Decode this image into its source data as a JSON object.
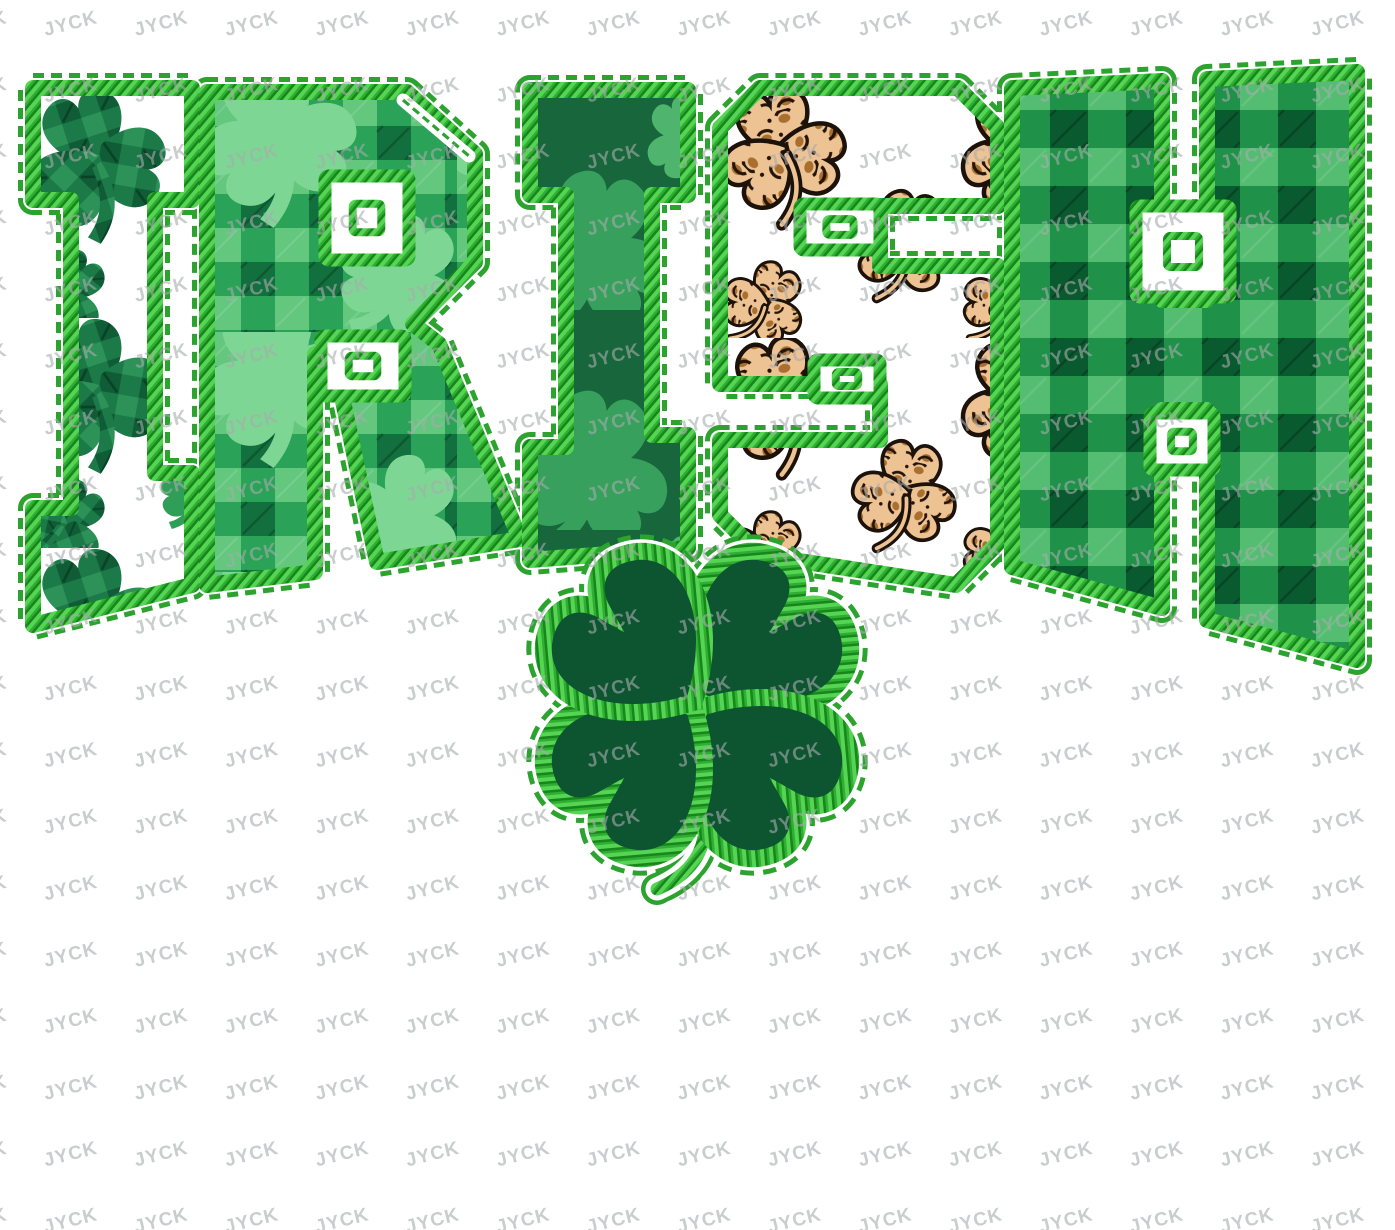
{
  "artwork": {
    "word": "IRISH",
    "letters": [
      {
        "char": "I",
        "fabric": "white-shamrock-plaid"
      },
      {
        "char": "R",
        "fabric": "green-buffalo-plaid-shamrock"
      },
      {
        "char": "I",
        "fabric": "dark-green-shamrock"
      },
      {
        "char": "S",
        "fabric": "leopard-shamrock-white"
      },
      {
        "char": "H",
        "fabric": "green-buffalo-plaid"
      }
    ],
    "motif": "four-leaf-clover"
  },
  "watermark": {
    "text": "JYCK",
    "color": "#a8acad"
  },
  "colors": {
    "background": "#ffffff",
    "stitch_green": "#2da32f",
    "satin_light": "#56d453",
    "satin_mid": "#2fae33",
    "satin_dark": "#17861b",
    "clover_fill": "#0d5431",
    "plaid_light": "#63c77e",
    "plaid_mid": "#2aa257",
    "plaid_dark": "#12703f",
    "plaid2_light": "#55bd72",
    "plaid2_mid": "#1f9148",
    "plaid2_dark": "#0a5a30",
    "dark_fabric": "#17663c",
    "shamrock_light": "#7ed694",
    "shamrock_mid": "#2f9e57",
    "leopard_base": "#eec394",
    "leopard_spot": "#a96f2f",
    "leopard_dark": "#241307"
  }
}
